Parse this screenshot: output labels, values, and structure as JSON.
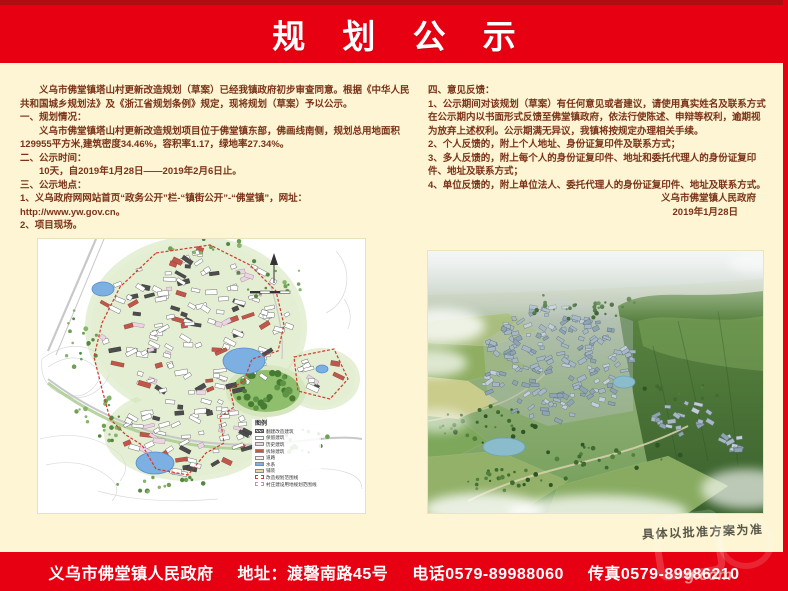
{
  "title": "规 划 公 示",
  "notice": {
    "left": {
      "intro": "义乌市佛堂镇塔山村更新改造规划（草案）已经我镇政府初步审查同意。根据《中华人民共和国城乡规划法》及《浙江省规划条例》规定，现将规划（草案）予以公示。",
      "sec1_title": "一、规划情况：",
      "sec1_body": "义乌市佛堂镇塔山村更新改造规划项目位于佛堂镇东部，佛画线南侧，规划总用地面积129955平方米,建筑密度34.46%，容积率1.17，绿地率27.34%。",
      "sec2_title": "二、公示时间：",
      "sec2_body": "10天，自2019年1月28日——2019年2月6日止。",
      "sec3_title": "三、公示地点：",
      "sec3_item1": "1、义乌政府网网站首页“政务公开”栏-“镇街公开”-“佛堂镇”，网址：http://www.yw.gov.cn。",
      "sec3_item2": "2、项目现场。"
    },
    "right": {
      "sec4_title": "四、意见反馈：",
      "sec4_item1": "1、公示期间对该规划（草案）有任何意见或者建议，请使用真实姓名及联系方式在公示期内以书面形式反馈至佛堂镇政府，依法行使陈述、申辩等权利，逾期视为放弃上述权利。公示期满无异议，我镇将按规定办理相关手续。",
      "sec4_item2": "2、个人反馈的，附上个人地址、身份证复印件及联系方式；",
      "sec4_item3": "3、多人反馈的，附上每个人的身份证复印件、地址和委托代理人的身份证复印件、地址及联系方式；",
      "sec4_item4": "4、单位反馈的，附上单位法人、委托代理人的身份证复印件、地址及联系方式。",
      "signature": "义乌市佛堂镇人民政府",
      "date": "2019年1月28日"
    }
  },
  "map_legend": {
    "title": "图例",
    "items": [
      {
        "label": "翻建改造建筑",
        "swatch": "hatch"
      },
      {
        "label": "保留建筑",
        "swatch": "#ffffff"
      },
      {
        "label": "历史建筑",
        "swatch": "#ecd5e3"
      },
      {
        "label": "拆除建筑",
        "swatch": "#c0574a"
      },
      {
        "label": "道路",
        "swatch": "#f2f2f2"
      },
      {
        "label": "水系",
        "swatch": "#7fb2e0"
      },
      {
        "label": "铺装",
        "swatch": "#e8d9a8"
      },
      {
        "label": "改造规划范围线",
        "swatch": "dashed-red"
      },
      {
        "label": "村庄建设用地规划范围线",
        "swatch": "dashed-pink"
      }
    ]
  },
  "approval_note": "具体以批准方案为准",
  "footer": {
    "segments": [
      "义乌市佛堂镇人民政府",
      "地址：渡磬南路45号",
      "电话0579-89988060",
      "传真0579-89986210"
    ]
  },
  "watermark": "g.com",
  "colors": {
    "banner_red": "#e60012",
    "banner_dark_red": "#b00d12",
    "background_cream": "#fdf5d3",
    "body_text_brown": "#7a3318",
    "footer_text": "#ffffff",
    "map_boundary_red": "#d2392e",
    "water_blue": "#7cb0e2",
    "park_green": "#8fbf6d"
  }
}
